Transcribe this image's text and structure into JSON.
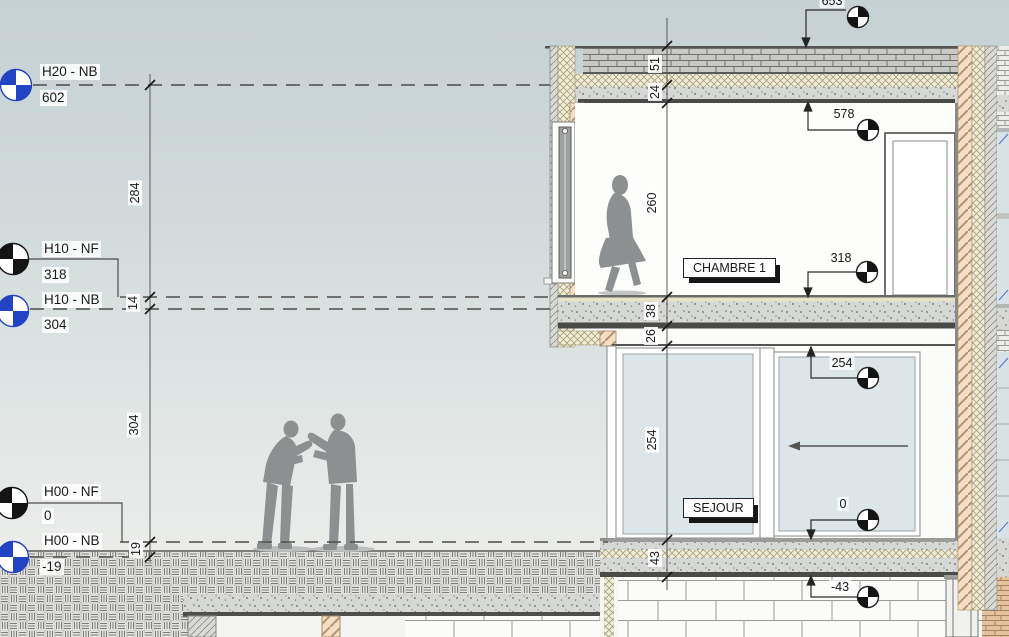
{
  "levels": [
    {
      "label": "H20 - NB",
      "value": "602",
      "marker": "blue"
    },
    {
      "label": "H10 - NF",
      "value": "318",
      "marker": "black"
    },
    {
      "label": "H10 - NB",
      "value": "304",
      "marker": "blue"
    },
    {
      "label": "H00 - NF",
      "value": "0",
      "marker": "black"
    },
    {
      "label": "H00 - NB",
      "value": "-19",
      "marker": "blue"
    }
  ],
  "left_dim_chain": {
    "h20_to_h10nf": "284",
    "h10nf_to_h10nb": "14",
    "h10nb_to_h00nf": "304",
    "h00nf_to_h00nb": "19"
  },
  "interior_dim_chain": {
    "roof_finish": "51",
    "roof_slab": "24",
    "chambre_height": "260",
    "floor_finish": "38",
    "floor_slab": "26",
    "sejour_height": "254",
    "ground_slab": "43"
  },
  "spot_elevations": {
    "roof_top": "653",
    "chambre_ceiling": "578",
    "chambre_floor": "318",
    "sejour_ceiling": "254",
    "sejour_floor": "0",
    "foundation": "-43"
  },
  "rooms": {
    "chambre": "CHAMBRE 1",
    "sejour": "SEJOUR"
  },
  "colors": {
    "level_marker_blue": "#2243c4",
    "marker_black": "#141414",
    "glass": "#dce5e7",
    "insulation_hatch": "#f1ecd2",
    "wood_hatch": "#f5dfc4",
    "glazing_mark_blue": "#4a6fd4"
  }
}
